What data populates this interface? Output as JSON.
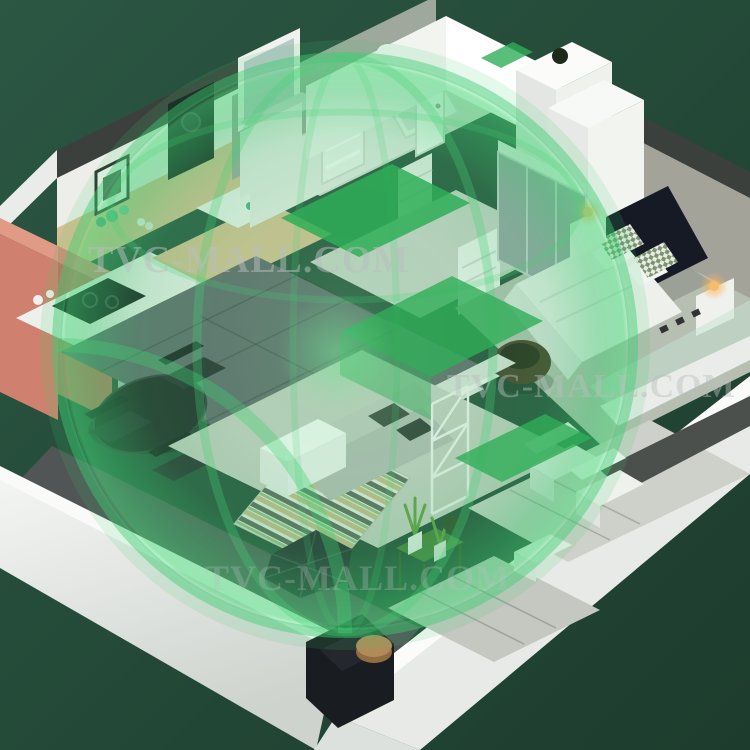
{
  "image": {
    "kind": "3d-isometric-apartment-render",
    "description": "Isometric cutaway apartment floor plan with translucent green wireless-coverage dome overlay on a dark green backdrop"
  },
  "watermarks": [
    {
      "text": "TVC-MALL.COM"
    },
    {
      "text": "TVC-MALL.COM"
    },
    {
      "text": "TVC-MALL.COM"
    }
  ],
  "palette": {
    "background_top": "#2b5743",
    "background_bottom": "#1d3c2d",
    "coverage_green": "#2fae57",
    "coverage_rim": "#3ecb72",
    "watermark": "#b9c0be",
    "wall_white": "#f1f3f0",
    "concrete": "#a4a39a",
    "coral_cabinet": "#d0806e",
    "wood_counter": "#d8bf92",
    "headboard_navy": "#161a24",
    "floor_dark_tile": "#61666b",
    "floor_light": "#c8cdc3",
    "lamp_glow": "#f7bb69",
    "plant_green": "#5f9c3f"
  },
  "rooms": [
    {
      "name": "bathroom"
    },
    {
      "name": "hallway"
    },
    {
      "name": "bedroom"
    },
    {
      "name": "kitchen"
    },
    {
      "name": "dining-area"
    },
    {
      "name": "living-room"
    },
    {
      "name": "balcony"
    },
    {
      "name": "entry"
    }
  ]
}
